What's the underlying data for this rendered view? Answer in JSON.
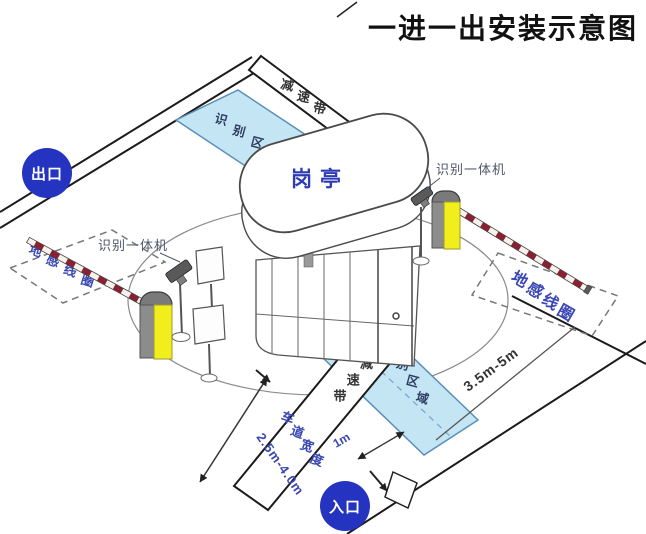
{
  "title": "一进一出安装示意图",
  "badges": {
    "exit": "出口",
    "entrance": "入口"
  },
  "booth": {
    "label": "岗亭"
  },
  "labels": {
    "recognition_machine_left": "识别一体机",
    "recognition_machine_right": "识别一体机",
    "ground_coil_left": "地感线圈",
    "ground_coil_right": "地感线圈",
    "recognition_area_top": "识别区域",
    "recognition_area_bottom": "识别区域",
    "speed_bump_top": "减速带",
    "speed_bump_bottom": "减速带"
  },
  "measurements": {
    "lane_width_label": "车道宽度",
    "lane_width_value": "2.5m-4.0m",
    "coil_distance": "3.5m-5m",
    "area_gap": "1m"
  },
  "colors": {
    "badge_blue": "#2433c0",
    "label_blue": "#3947b3",
    "area_fill": "#c4e5f3",
    "area_stroke": "#5b8fb8",
    "arm_red": "#8b2130",
    "machine_yellow": "#f2ee1c",
    "machine_gray": "#7a7a7a",
    "line_dark": "#1b1b1b"
  }
}
